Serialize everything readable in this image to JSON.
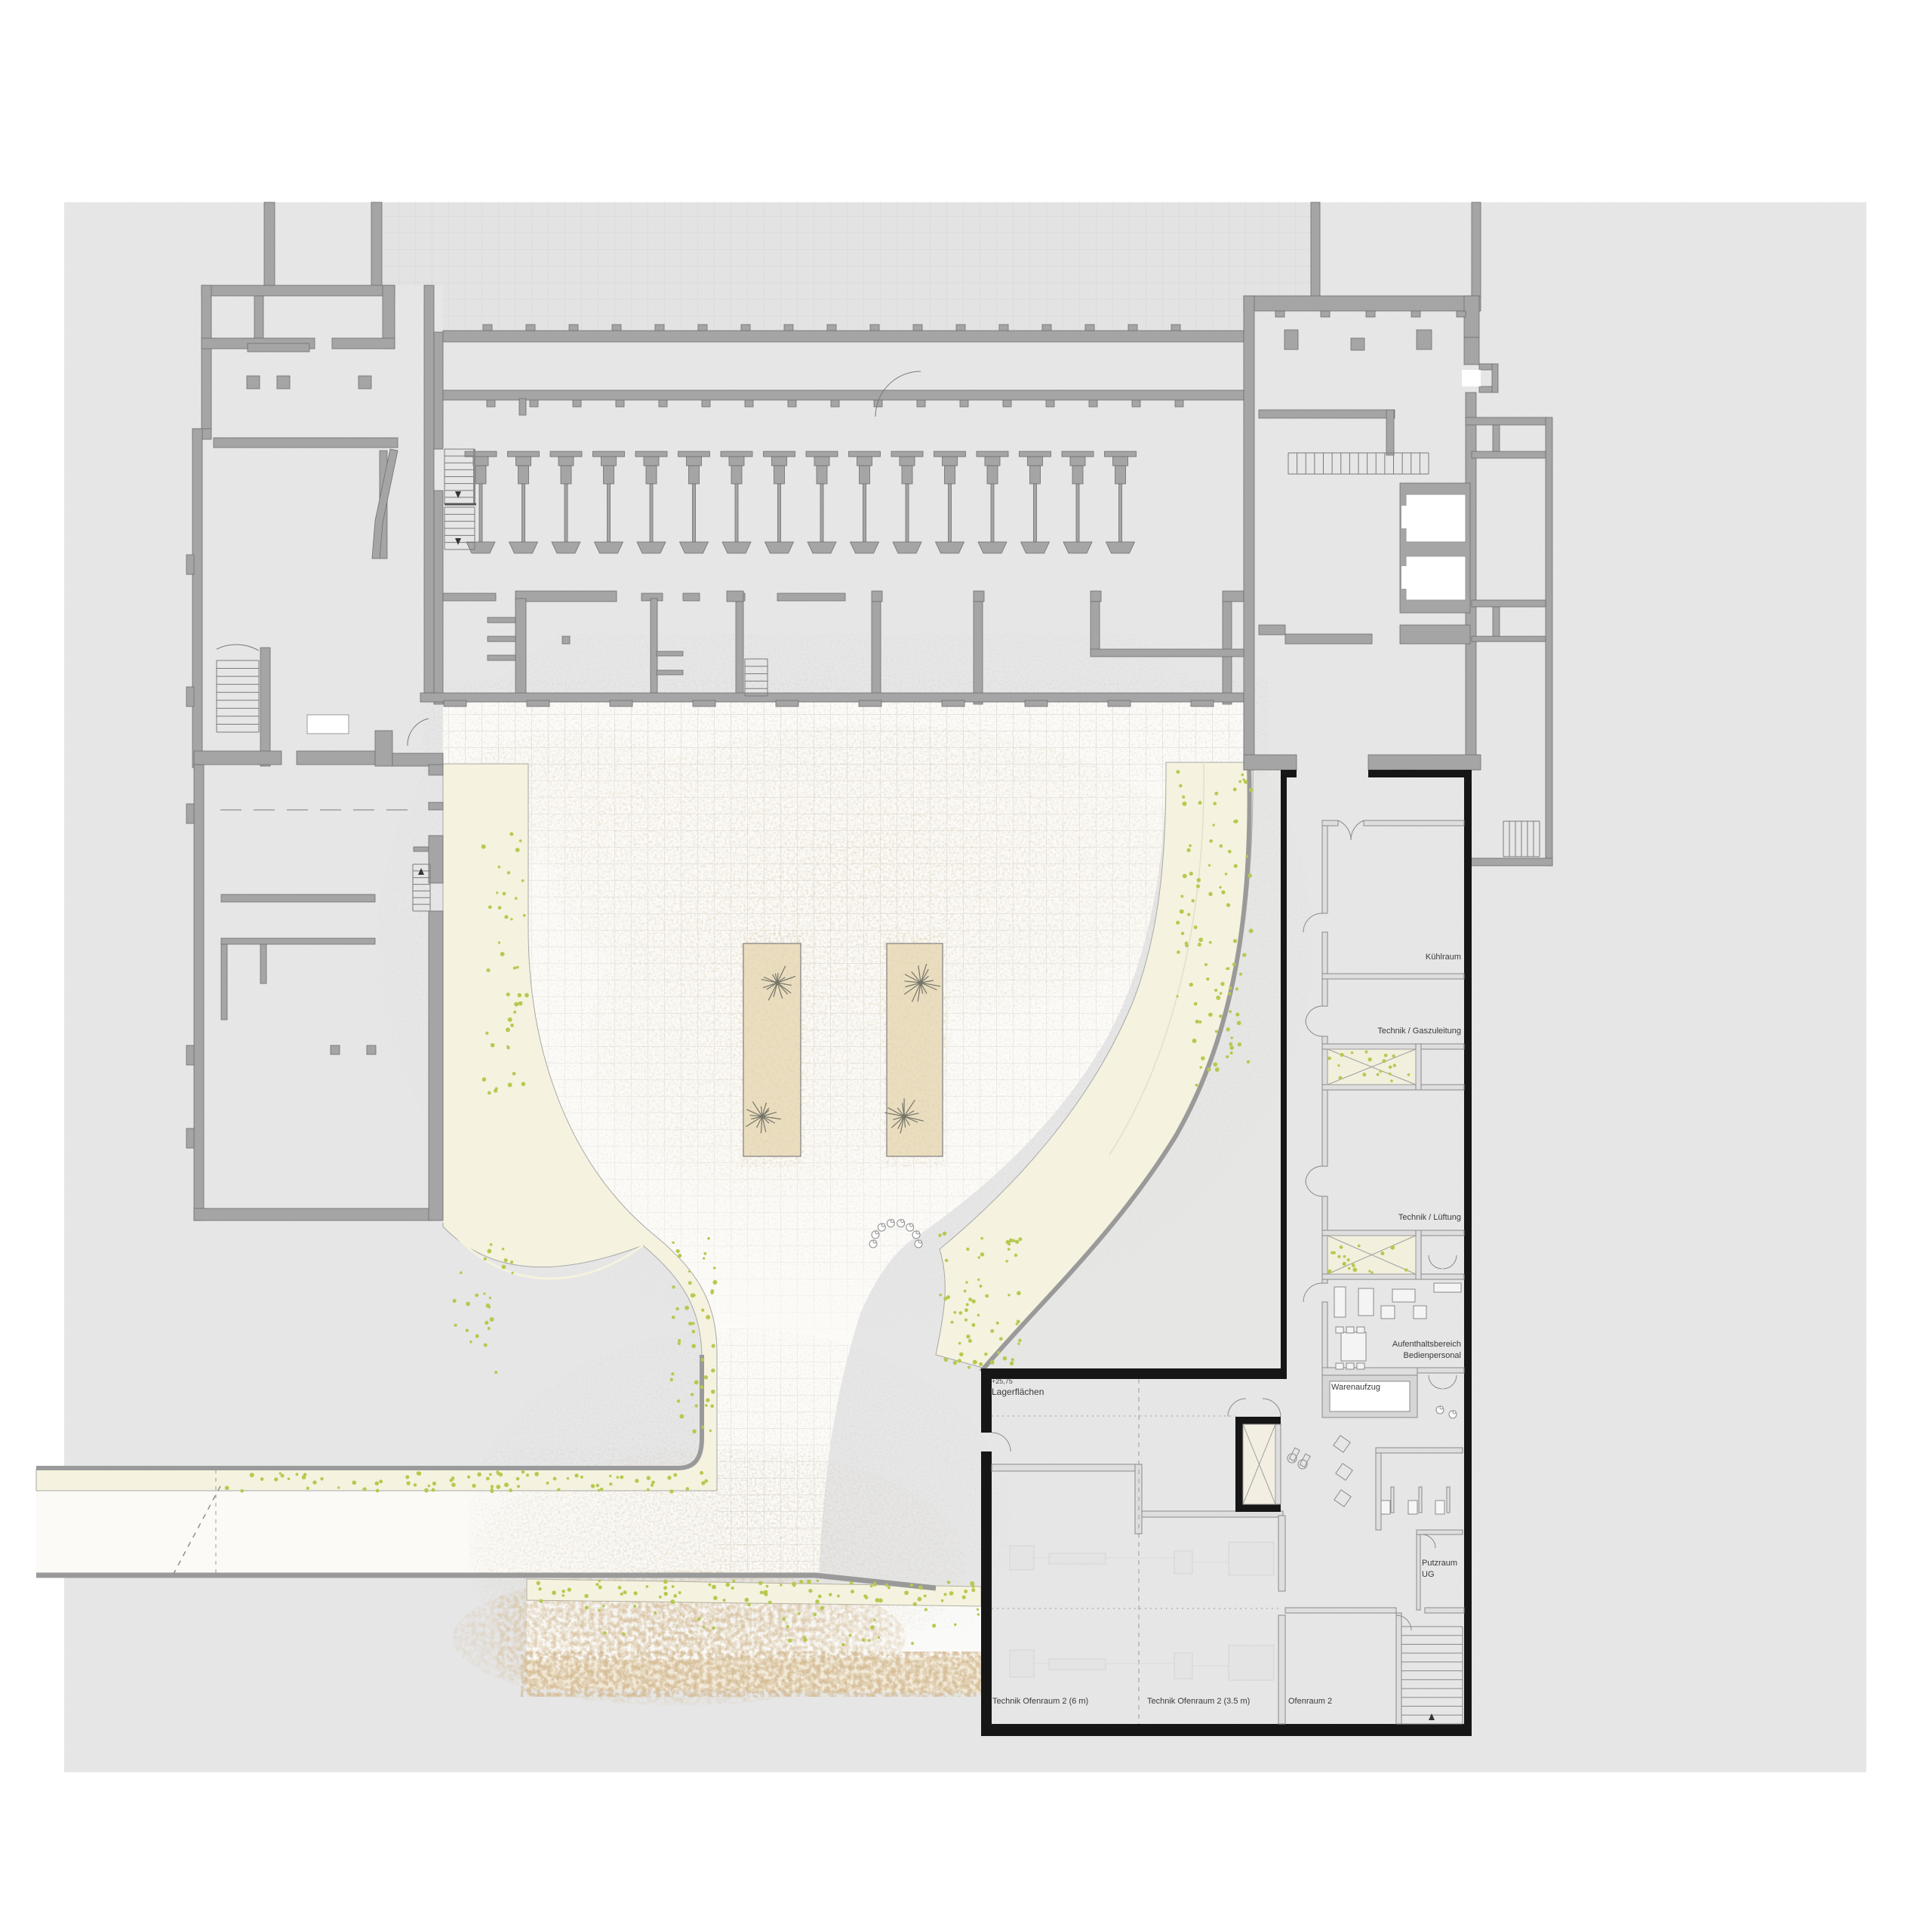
{
  "plan": {
    "rooms": {
      "kuehlraum": "Kühlraum",
      "technik_gaszuleitung": "Technik / Gaszuleitung",
      "technik_lueftung": "Technik / Lüftung",
      "aufenthaltsbereich_line1": "Aufenthaltsbereich",
      "aufenthaltsbereich_line2": "Bedienpersonal",
      "warenaufzug": "Warenaufzug",
      "putzraum_line1": "Putzraum",
      "putzraum_line2": "UG",
      "level_mark": "+25,75",
      "lagerflaechen": "Lagerflächen",
      "technik_ofenraum_6m": "Technik Ofenraum 2 (6 m)",
      "technik_ofenraum_35m": "Technik Ofenraum 2 (3.5 m)",
      "ofenraum_2": "Ofenraum 2"
    },
    "colors": {
      "paper": "#e8e8e8",
      "wall_gray": "#a5a5a5",
      "wall_black": "#161616",
      "ramp_cream": "#f5f2df",
      "planting_tan": "#eadec0",
      "greenery": "#b6c94f",
      "label_text": "#3a3a3a"
    }
  }
}
